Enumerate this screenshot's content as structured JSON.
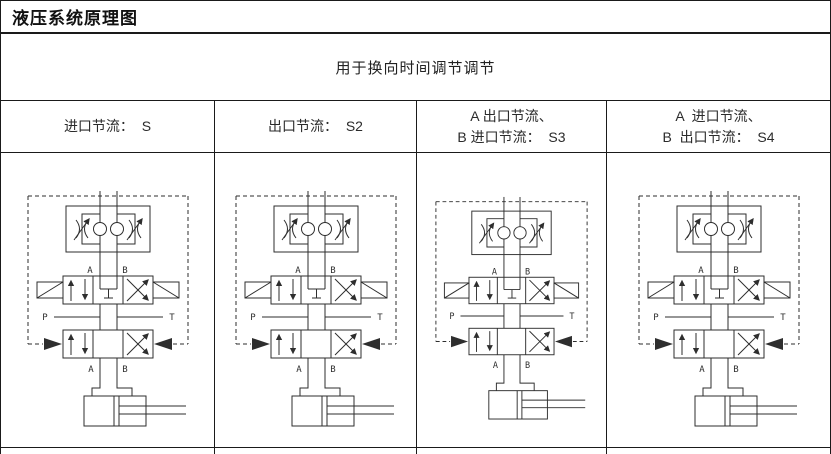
{
  "window": {
    "title": "液压系统原理图",
    "subtitle": "用于换向时间调节调节"
  },
  "table": {
    "headers": [
      {
        "lines": [
          "进口节流：  S",
          ""
        ]
      },
      {
        "lines": [
          "出口节流：  S2",
          ""
        ]
      },
      {
        "lines": [
          "A 出口节流、",
          "B 进口节流：  S3"
        ]
      },
      {
        "lines": [
          "A  进口节流、",
          "B  出口节流：  S4"
        ]
      }
    ]
  },
  "schematic": {
    "port_a_top": "A",
    "port_b_top": "B",
    "port_p": "P",
    "port_t": "T",
    "port_a_bottom": "A",
    "port_b_bottom": "B"
  },
  "colors": {
    "border": "#1a1a1a",
    "schematic_line": "#2e2e2e",
    "background": "#ffffff"
  }
}
